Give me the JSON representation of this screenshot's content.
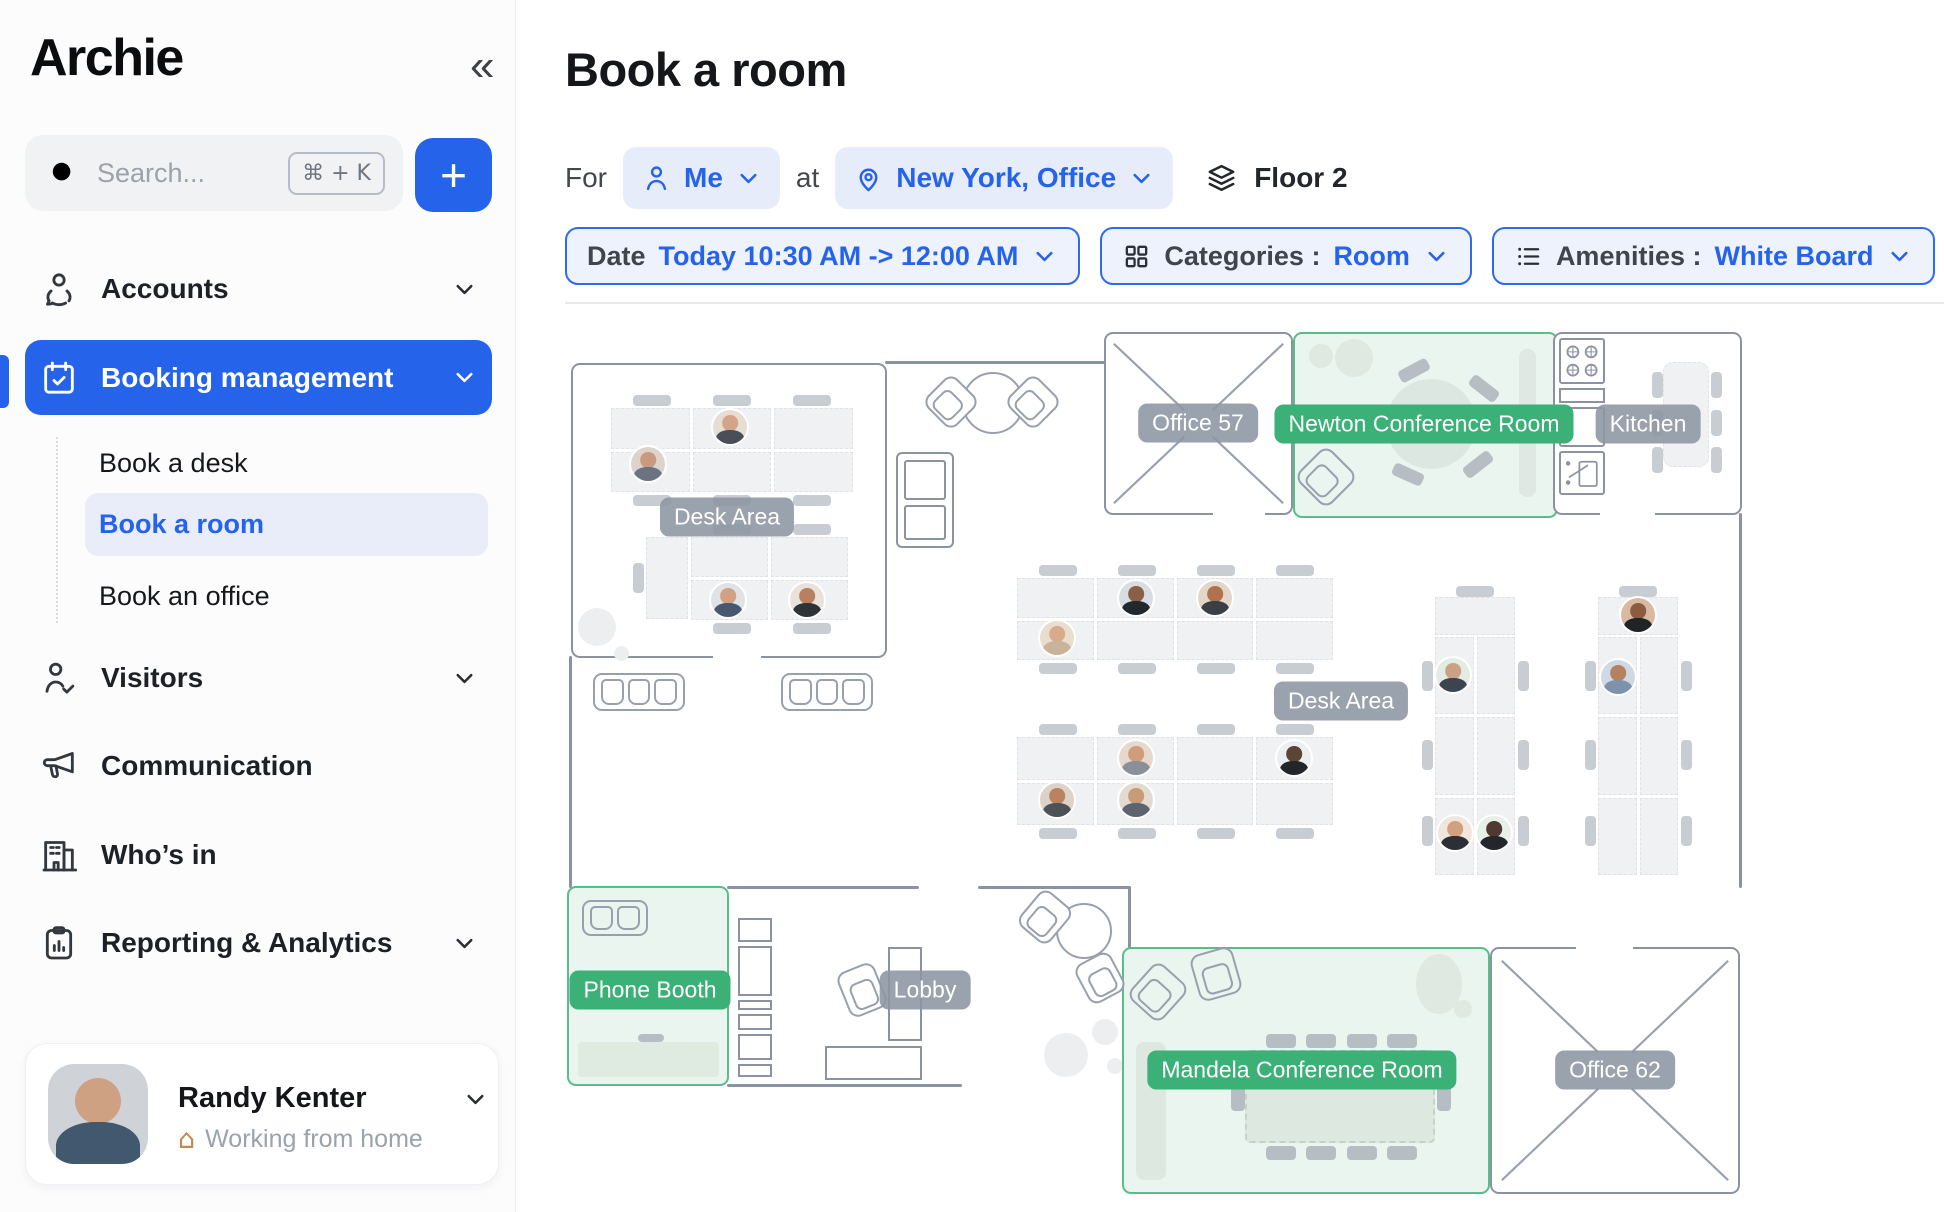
{
  "sidebar": {
    "logo": "Archie",
    "collapse_icon": "«",
    "search": {
      "placeholder": "Search...",
      "shortcut": "⌘ + K"
    },
    "add_button": "+",
    "items": {
      "accounts": "Accounts",
      "booking": "Booking management",
      "visitors": "Visitors",
      "communication": "Communication",
      "whos_in": "Who’s in",
      "reporting": "Reporting & Analytics"
    },
    "booking_children": {
      "desk": "Book a desk",
      "room": "Book a room",
      "office": "Book an office"
    },
    "user": {
      "name": "Randy Kenter",
      "status": "Working from home",
      "house_icon": "⌂"
    }
  },
  "header": {
    "title": "Book a room",
    "for_label": "For",
    "person": "Me",
    "at_label": "at",
    "location": "New York, Office",
    "floor": "Floor 2"
  },
  "filters": {
    "date_label": "Date",
    "date_value": "Today 10:30 AM -> 12:00 AM",
    "categories_label": "Categories :",
    "categories_value": "Room",
    "amenities_label": "Amenities :",
    "amenities_value": "White Board"
  },
  "floorplan": {
    "desk_area_label": "Desk Area",
    "rooms": {
      "office57": "Office 57",
      "newton": "Newton Conference Room",
      "kitchen": "Kitchen",
      "phone_booth": "Phone Booth",
      "lobby": "Lobby",
      "mandela": "Mandela Conference Room",
      "office62": "Office 62"
    }
  },
  "colors": {
    "accent": "#2563eb",
    "green": "#3bb077",
    "green_fill": "#e9f5ee",
    "wall": "#8b93a2"
  }
}
